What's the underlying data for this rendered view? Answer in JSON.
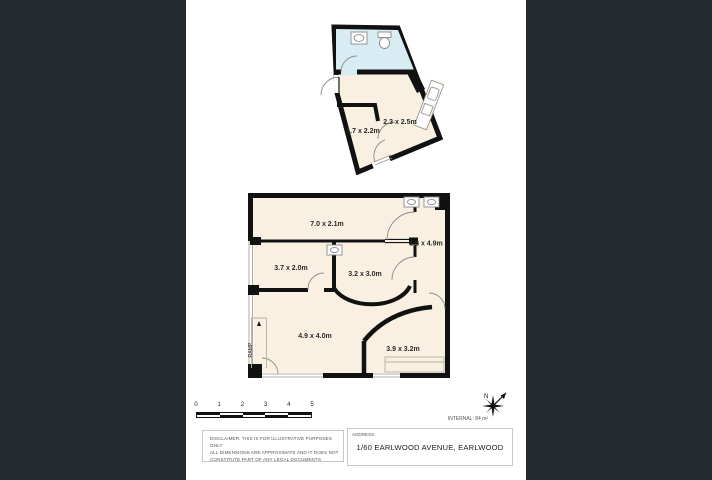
{
  "colors": {
    "background": "#232a30",
    "sheet": "#ffffff",
    "wall": "#111111",
    "floor": "#faf0e2",
    "bathroom_floor": "#d8ecf4",
    "fixture_outline": "#9a968a"
  },
  "upper_plan": {
    "rooms": [
      {
        "label": "2.3 x 2.5m"
      },
      {
        "label": "1.7 x 2.2m"
      }
    ]
  },
  "main_plan": {
    "rooms": [
      {
        "label": "7.0 x 2.1m"
      },
      {
        "label": "1.8 x 4.9m"
      },
      {
        "label": "3.7 x 2.0m"
      },
      {
        "label": "3.2 x 3.0m"
      },
      {
        "label": "4.9 x 4.0m"
      },
      {
        "label": "3.9 x 3.2m"
      }
    ],
    "ramp_label": "RAMP"
  },
  "scale_bar": {
    "ticks": [
      "0",
      "1",
      "2",
      "3",
      "4",
      "5"
    ]
  },
  "compass": {
    "north_label": "N"
  },
  "area_note": "INTERNAL: 84 m²",
  "disclaimer": {
    "line1": "DISCLAIMER: THIS IS FOR ILLUSTRATIVE PURPOSES ONLY",
    "line2": "ALL DIMENSIONS ARE APPROXIMATE AND IT DOES NOT",
    "line3": "CONSTITUTE PART OF ANY LEGAL DOCUMENTS"
  },
  "address": {
    "label": "ADDRESS:",
    "value": "1/60 EARLWOOD AVENUE, EARLWOOD"
  }
}
